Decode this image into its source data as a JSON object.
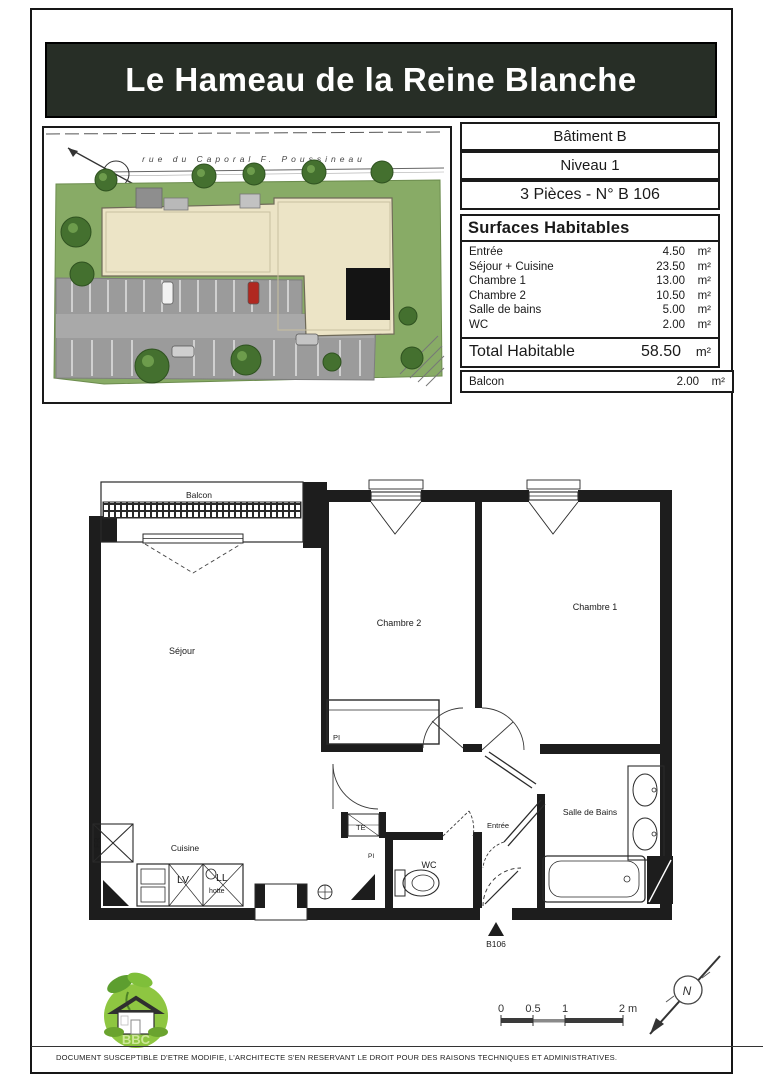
{
  "title": "Le Hameau de la Reine Blanche",
  "site_plan": {
    "street_label": "rue  du  Caporal  F.  Poussineau"
  },
  "info": {
    "building": "Bâtiment B",
    "level": "Niveau 1",
    "unit": "3 Pièces - N° B 106"
  },
  "surfaces": {
    "header": "Surfaces Habitables",
    "rows": [
      {
        "label": "Entrée",
        "value": "4.50",
        "unit": "m²"
      },
      {
        "label": "Séjour + Cuisine",
        "value": "23.50",
        "unit": "m²"
      },
      {
        "label": "Chambre 1",
        "value": "13.00",
        "unit": "m²"
      },
      {
        "label": "Chambre 2",
        "value": "10.50",
        "unit": "m²"
      },
      {
        "label": "Salle de bains",
        "value": "5.00",
        "unit": "m²"
      },
      {
        "label": "WC",
        "value": "2.00",
        "unit": "m²"
      }
    ],
    "total_label": "Total Habitable",
    "total_value": "58.50",
    "total_unit": "m²",
    "balcony_label": "Balcon",
    "balcony_value": "2.00",
    "balcony_unit": "m²"
  },
  "floor_plan": {
    "labels": {
      "balcon": "Balcon",
      "sejour": "Séjour",
      "chambre2": "Chambre 2",
      "chambre1": "Chambre 1",
      "cuisine": "Cuisine",
      "wc": "WC",
      "entree": "Entrée",
      "salle_de_bains": "Salle de Bains",
      "pi": "PI",
      "te": "TE",
      "fr": "FR",
      "lv": "LV",
      "ll": "LL",
      "hotte": "hotte",
      "unit_marker": "B106"
    }
  },
  "scale_bar": {
    "t0": "0",
    "t05": "0.5",
    "t1": "1",
    "t2": "2 m"
  },
  "north_label": "N",
  "bbc_label": "BBC",
  "disclaimer": "DOCUMENT SUSCEPTIBLE D'ETRE MODIFIE, L'ARCHITECTE S'EN RESERVANT LE DROIT POUR DES RAISONS TECHNIQUES ET ADMINISTRATIVES.",
  "colors": {
    "title_bg": "#272e26",
    "wall": "#1d1d1d",
    "grass": "#88ab66",
    "building": "#ece4c6",
    "parking": "#9b9b9b",
    "tree": "#44702f",
    "bbc_green": "#8ec641"
  }
}
